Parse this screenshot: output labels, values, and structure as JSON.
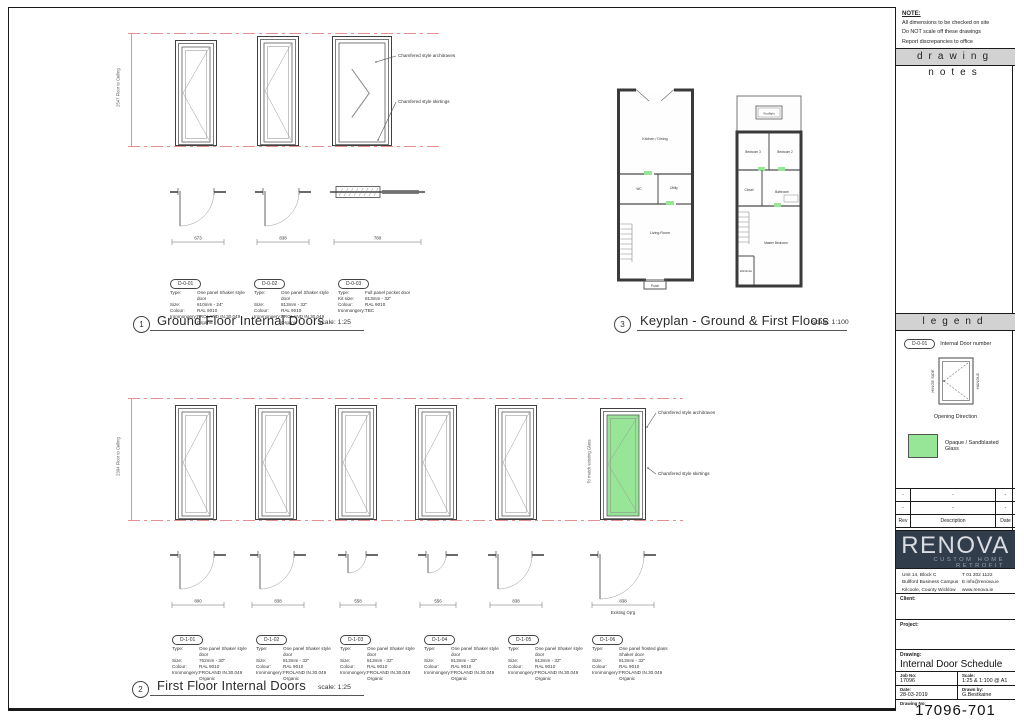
{
  "notes": {
    "heading": "NOTE:",
    "lines": [
      "All dimensions to be checked on site",
      "Do NOT scale off these drawings",
      "Report discrepancies to office"
    ]
  },
  "panel_bands": {
    "drawing_notes": "drawing notes",
    "legend": "legend"
  },
  "legend": {
    "door_tag": "D-0-01",
    "door_tag_label": "Internal Door number",
    "hinge_label": "HINGE SIDE",
    "handle_label": "HANDLE",
    "opening_label": "Opening Direction",
    "glass_label": "Opaque / Sandblasted Glass"
  },
  "revisions": {
    "headers": {
      "rev": "Rev",
      "description": "Description",
      "date": "Date"
    },
    "rows": [
      {
        "rev": "-",
        "description": "-",
        "date": "-"
      },
      {
        "rev": "-",
        "description": "-",
        "date": "-"
      }
    ]
  },
  "title_block": {
    "logo": "RENOVA",
    "tagline": "CUSTOM HOME RETROFIT",
    "address_lines": [
      "Unit 14, Block C",
      "Bullford Business Campus",
      "Kilcoole, County Wicklow"
    ],
    "contact_lines": [
      "T 01 202 1122",
      "E info@renova.ie",
      "www.renova.ie"
    ],
    "client_label": "Client:",
    "project_label": "Project:",
    "drawing_label": "Drawing:",
    "drawing_title": "Internal Door Schedule",
    "job_no_label": "Job No:",
    "job_no": "17096",
    "scale_label": "Scale:",
    "scale": "1:25 & 1:100 @ A1",
    "date_label": "Date:",
    "date": "28-03-2019",
    "drawn_by_label": "Drawn by:",
    "drawn_by": "G.Bestkaine",
    "drawing_no_label": "Drawing No:",
    "drawing_no": "17096-701"
  },
  "sections": {
    "ground": {
      "number": "1",
      "title": "Ground Floor Internal Doors",
      "scale": "scale: 1:25"
    },
    "first": {
      "number": "2",
      "title": "First Floor Internal Doors",
      "scale": "scale: 1:25"
    },
    "keyplan": {
      "number": "3",
      "title": "Keyplan - Ground & First Floors",
      "scale": "scale: 1:100"
    }
  },
  "annotations": {
    "architraves": "Chamfered style architraves",
    "skirtings": "Chamfered style skirtings",
    "glass_note": "To match existing Glass",
    "existing_opening": "Existing Op'g"
  },
  "ground_floor": {
    "height_note": "2547 Floor to Ceiling",
    "doors": [
      {
        "tag": "D-0-01",
        "specs": [
          {
            "k": "Type:",
            "v": "One panel Shaker style door"
          },
          {
            "k": "Size:",
            "v": "610mm - 24\""
          },
          {
            "k": "Colour:",
            "v": "RAL 9010"
          },
          {
            "k": "Ironmongery:",
            "v": "FROLAND IN.30.049 Organic"
          }
        ],
        "plan_dim": "673"
      },
      {
        "tag": "D-0-02",
        "specs": [
          {
            "k": "Type:",
            "v": "One panel Shaker style door"
          },
          {
            "k": "Size:",
            "v": "813mm - 32\""
          },
          {
            "k": "Colour:",
            "v": "RAL 9010"
          },
          {
            "k": "Ironmongery:",
            "v": "FROLAND IN.30.049 Organic"
          }
        ],
        "plan_dim": "838"
      },
      {
        "tag": "D-0-03",
        "specs": [
          {
            "k": "Type:",
            "v": "Full panel pocket door"
          },
          {
            "k": "Kit size:",
            "v": "813mm - 32\""
          },
          {
            "k": "Colour:",
            "v": "RAL 9010"
          },
          {
            "k": "Ironmongery:",
            "v": "TBC"
          }
        ],
        "plan_dim": "780"
      }
    ]
  },
  "first_floor": {
    "height_note": "2394 Floor to Ceiling",
    "doors": [
      {
        "tag": "D-1-01",
        "specs": [
          {
            "k": "Type:",
            "v": "One panel Shaker style door"
          },
          {
            "k": "Size:",
            "v": "762mm - 30\""
          },
          {
            "k": "Colour:",
            "v": "RAL 9010"
          },
          {
            "k": "Ironmongery:",
            "v": "FROLAND IN.30.049 Organic"
          }
        ],
        "plan_dim": "800"
      },
      {
        "tag": "D-1-02",
        "specs": [
          {
            "k": "Type:",
            "v": "One panel Shaker style door"
          },
          {
            "k": "Size:",
            "v": "813mm - 32\""
          },
          {
            "k": "Colour:",
            "v": "RAL 9010"
          },
          {
            "k": "Ironmongery:",
            "v": "FROLAND IN.30.049 Organic"
          }
        ],
        "plan_dim": "838"
      },
      {
        "tag": "D-1-03",
        "specs": [
          {
            "k": "Type:",
            "v": "One panel Shaker style door"
          },
          {
            "k": "Size:",
            "v": "813mm - 32\""
          },
          {
            "k": "Colour:",
            "v": "RAL 9010"
          },
          {
            "k": "Ironmongery:",
            "v": "FROLAND IN.30.049 Organic"
          }
        ],
        "plan_dim": "558"
      },
      {
        "tag": "D-1-04",
        "specs": [
          {
            "k": "Type:",
            "v": "One panel Shaker style door"
          },
          {
            "k": "Size:",
            "v": "813mm - 32\""
          },
          {
            "k": "Colour:",
            "v": "RAL 9010"
          },
          {
            "k": "Ironmongery:",
            "v": "FROLAND IN.30.049 Organic"
          }
        ],
        "plan_dim": "556"
      },
      {
        "tag": "D-1-05",
        "specs": [
          {
            "k": "Type:",
            "v": "One panel Shaker style door"
          },
          {
            "k": "Size:",
            "v": "813mm - 32\""
          },
          {
            "k": "Colour:",
            "v": "RAL 9010"
          },
          {
            "k": "Ironmongery:",
            "v": "FROLAND IN.30.049 Organic"
          }
        ],
        "plan_dim": "838"
      },
      {
        "tag": "D-1-06",
        "specs": [
          {
            "k": "Type:",
            "v": "One panel frosted glass Shaker door"
          },
          {
            "k": "Size:",
            "v": "813mm - 32\""
          },
          {
            "k": "Colour:",
            "v": "RAL 9010"
          },
          {
            "k": "Ironmongery:",
            "v": "FROLAND IN.30.049 Organic"
          }
        ],
        "plan_dim": "838",
        "plan_note": "Existing Op'g",
        "glass": true
      }
    ]
  },
  "keyplan": {
    "ground_rooms": {
      "kitchen": "Kitchen / Dining",
      "wc": "WC",
      "utility": "Utility",
      "living": "Living Room",
      "porch": "Porch"
    },
    "first_rooms": {
      "rooflight": "Rooflight",
      "bed3": "Bedroom 3",
      "bed2": "Bedroom 2",
      "closet": "Closet",
      "bath": "Bathroom",
      "master": "Master Bedroom",
      "wardrobe": "Wardrobe"
    }
  },
  "colors": {
    "datum_red": "#e4908f",
    "glass_green": "#97e697",
    "navy": "#323d4c",
    "band_gray": "#d2d2d2"
  }
}
